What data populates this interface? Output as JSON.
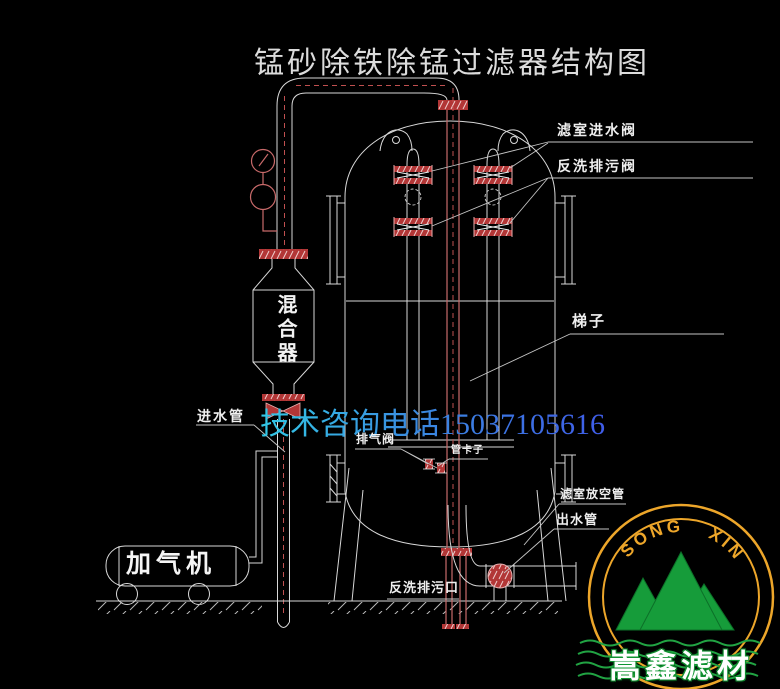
{
  "title": "锰砂除铁除锰过滤器结构图",
  "watermark": {
    "phone_text": "技术咨询电话15037105616"
  },
  "labels": {
    "inlet_pipe": "进水管",
    "exhaust_valve": "排气阀",
    "pipe_clamp": "管卡子",
    "backwash_drain_outlet": "反洗排污口",
    "filter_inlet_valve": "滤室进水阀",
    "backwash_drain_valve": "反洗排污阀",
    "ladder": "梯子",
    "vent_pipe": "滤室放空管",
    "outlet_pipe": "出水管"
  },
  "equipment": {
    "mixer": "混合器",
    "aerator": "加气机"
  },
  "logo": {
    "arc_text": "SONG XIN",
    "company_name": "嵩鑫滤材"
  },
  "colors": {
    "background": "#000000",
    "drawing_line": "#d9d9d9",
    "pipe_red": "#c86a6a",
    "flange_red": "#b23636",
    "phone_blue_start": "#32c8e6",
    "phone_blue_end": "#3f5ce8",
    "logo_ring_yellow": "#eda62a",
    "logo_mountain_green": "#169c3a",
    "logo_wave_green": "#21a343"
  }
}
